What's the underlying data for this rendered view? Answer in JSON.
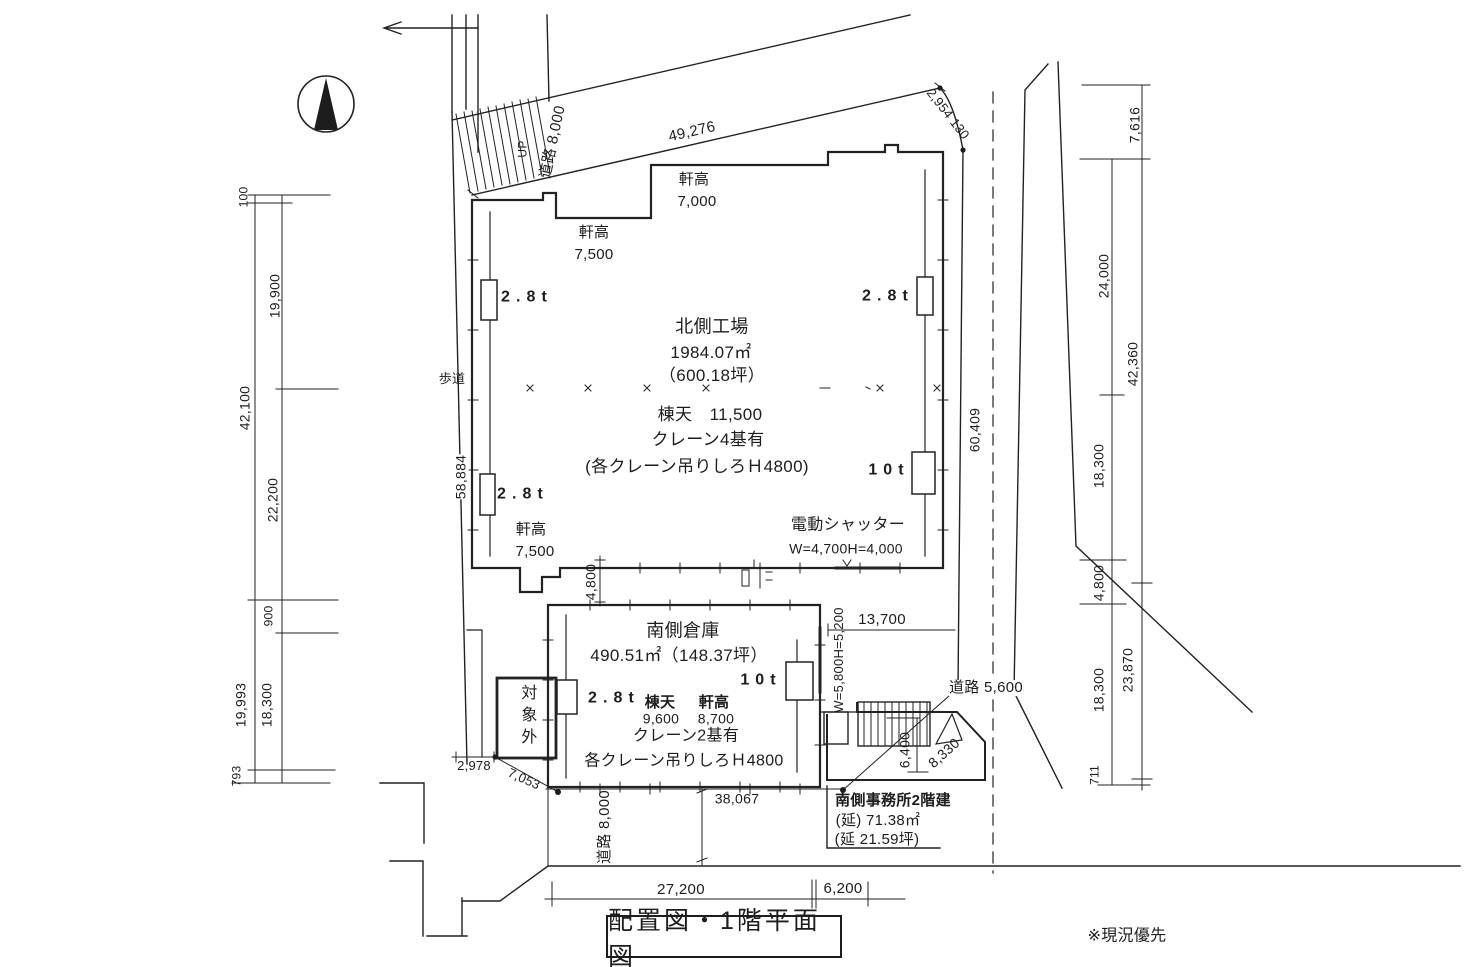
{
  "title": "配置図・1階平面図",
  "note": "※現況優先",
  "north_factory": {
    "name": "北側工場",
    "area": "1984.07㎡",
    "area_tsubo": "（600.18坪）",
    "ridge": "棟天　11,500",
    "cranes": "クレーン4基有",
    "crane_note": "(各クレーン吊りしろＨ4800)",
    "eave_label": "軒高",
    "eave_top_left": "7,500",
    "eave_top_right": "7,000",
    "eave_bottom_left": "7,500",
    "crane_28": "2.8t",
    "crane_10": "10t",
    "shutter_name": "電動シャッター",
    "shutter_size": "W=4,700H=4,000"
  },
  "south_warehouse": {
    "name": "南側倉庫",
    "area": "490.51㎡（148.37坪）",
    "ridge_label": "棟天",
    "ridge": "9,600",
    "eave_label": "軒高",
    "eave": "8,700",
    "cranes": "クレーン2基有",
    "crane_note": "各クレーン吊りしろＨ4800",
    "crane_28": "2.8t",
    "crane_10": "10t",
    "shutter_size": "W=5,800H=5,200"
  },
  "south_office": {
    "line1": "南側事務所2階建",
    "line2": "(延) 71.38㎡",
    "line3": "(延 21.59坪)"
  },
  "site": {
    "excluded": "対象外",
    "sidewalk": "歩道",
    "stairs": "UP"
  },
  "roads": {
    "top": "道路 8,000",
    "bottom": "道路 8,000",
    "right": "道路 5,600"
  },
  "dims": {
    "top_edge": "49,276",
    "top_right": "2,954 130",
    "factory_left": "58,884",
    "factory_right": "60,409",
    "gap": "4,800",
    "south_top": "13,700",
    "office_east": "6,400",
    "road_diagonal": "8,330",
    "south_bottom": "38,067",
    "bottom_left": "27,200",
    "bottom_right": "6,200",
    "sw_short": "2,978",
    "sw_diagonal": "7,053",
    "left_chain": [
      "100",
      "19,900",
      "42,100",
      "22,200",
      "900",
      "19,993",
      "18,300",
      "793"
    ],
    "right_chain": [
      "7,616",
      "24,000",
      "42,360",
      "18,300",
      "4,800",
      "18,300",
      "23,870",
      "711"
    ]
  },
  "colors": {
    "ink": "#1f1f1f",
    "paper": "#ffffff"
  }
}
